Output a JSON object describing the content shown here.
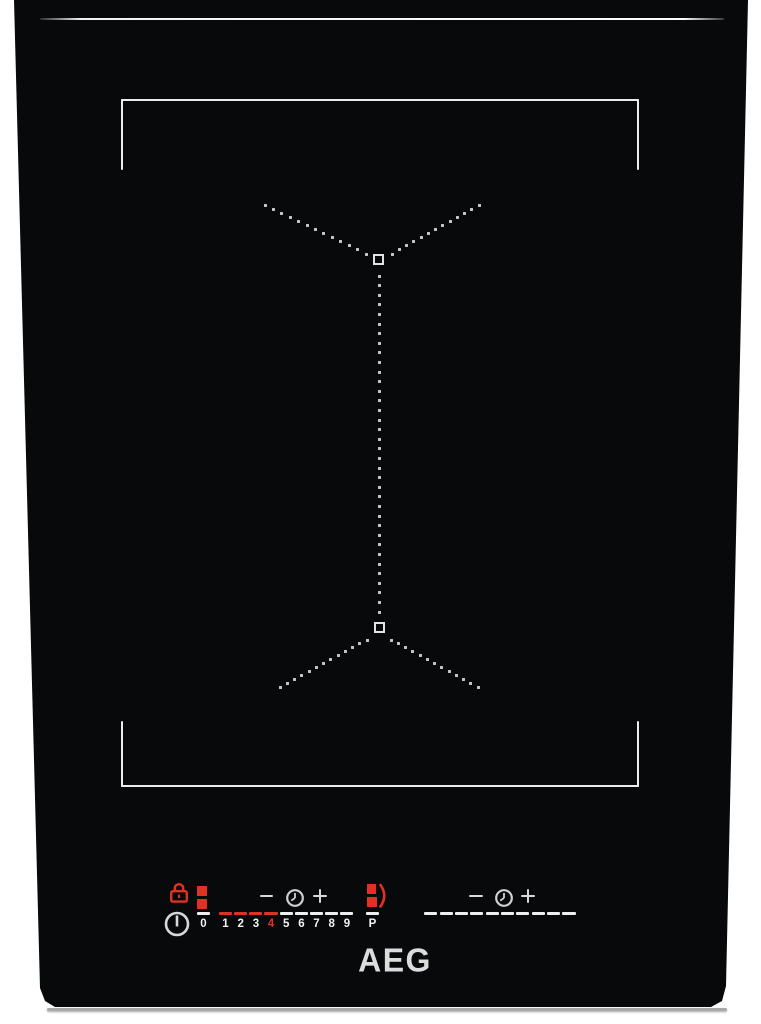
{
  "device": {
    "brand": "AEG",
    "type": "induction-hob"
  },
  "logo_text": "AEG",
  "colors": {
    "background": "#ffffff",
    "glass": "#08090a",
    "marking_white": "#ebebeb",
    "dot_grey": "#c6c6c6",
    "number_white": "#f2f2f2",
    "accent_red": "#e03222",
    "logo_grey": "#dcdcdc"
  },
  "icons": {
    "lock": "lock-icon",
    "power": "power-icon",
    "zone_pair": "zone-pair-indicator-icon",
    "minus": "minus-icon",
    "timer": "timer-clock-icon",
    "plus": "plus-icon",
    "bridge": "bridge-zones-icon"
  },
  "control_panel": {
    "left_zone": {
      "slider": {
        "levels": [
          "0",
          "1",
          "2",
          "3",
          "4",
          "5",
          "6",
          "7",
          "8",
          "9",
          "P"
        ],
        "active_level": "4",
        "red_levels": [
          "1",
          "2",
          "3",
          "4"
        ]
      }
    },
    "right_zone": {
      "slider_dash_count": 10
    }
  }
}
